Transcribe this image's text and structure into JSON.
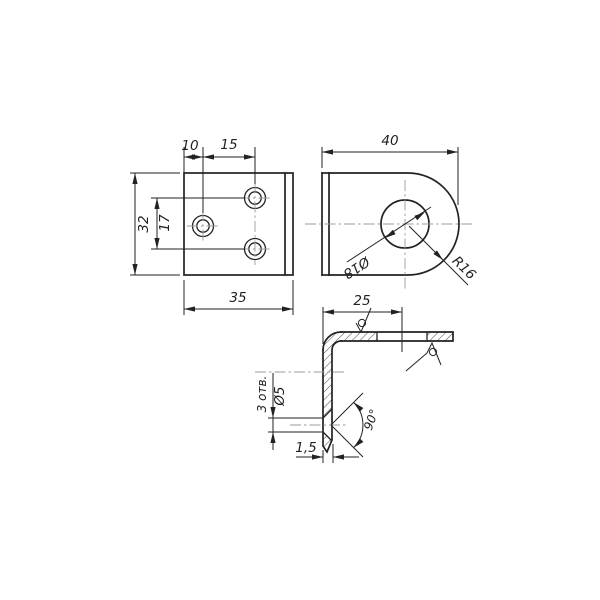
{
  "drawing": {
    "background": "#ffffff",
    "line_color": "#222222",
    "centerline_color": "#9b9b9b",
    "views": {
      "front": {
        "title": "front-view-of-plate",
        "dims": {
          "hole_offset": "10",
          "hole_spacing_h": "15",
          "plate_height": "32",
          "hole_spacing_v": "17",
          "plate_width": "35"
        }
      },
      "side": {
        "title": "side-view-rounded-lug",
        "dims": {
          "depth": "40",
          "hole_diameter": "Ø18",
          "end_radius": "R16"
        }
      },
      "section": {
        "title": "bent-section-view",
        "dims": {
          "leg_length": "25",
          "hole_diameter": "Ø5",
          "holes_note": "3 отв.",
          "countersink_angle": "90°",
          "thickness": "1,5"
        }
      }
    }
  }
}
